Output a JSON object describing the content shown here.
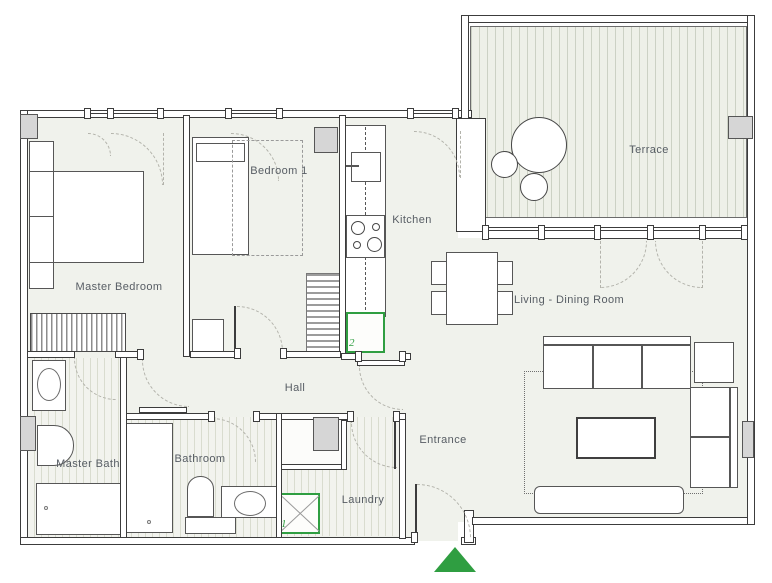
{
  "plan_title": "Apartment floor plan",
  "colors": {
    "accent_green": "#2f9e41",
    "floor_fill": "#f0f2ec",
    "wall_line": "#3c3c3c",
    "label_text": "#575d64"
  },
  "rooms": {
    "master_bedroom": {
      "label": "Master Bedroom"
    },
    "bedroom1": {
      "label": "Bedroom 1"
    },
    "kitchen": {
      "label": "Kitchen"
    },
    "terrace": {
      "label": "Terrace"
    },
    "living_dining": {
      "label": "Living - Dining Room"
    },
    "hall": {
      "label": "Hall"
    },
    "entrance": {
      "label": "Entrance"
    },
    "master_bath": {
      "label": "Master Bath"
    },
    "bathroom": {
      "label": "Bathroom"
    },
    "laundry": {
      "label": "Laundry"
    }
  },
  "markers": {
    "appliance_1": "1",
    "appliance_2": "2"
  }
}
